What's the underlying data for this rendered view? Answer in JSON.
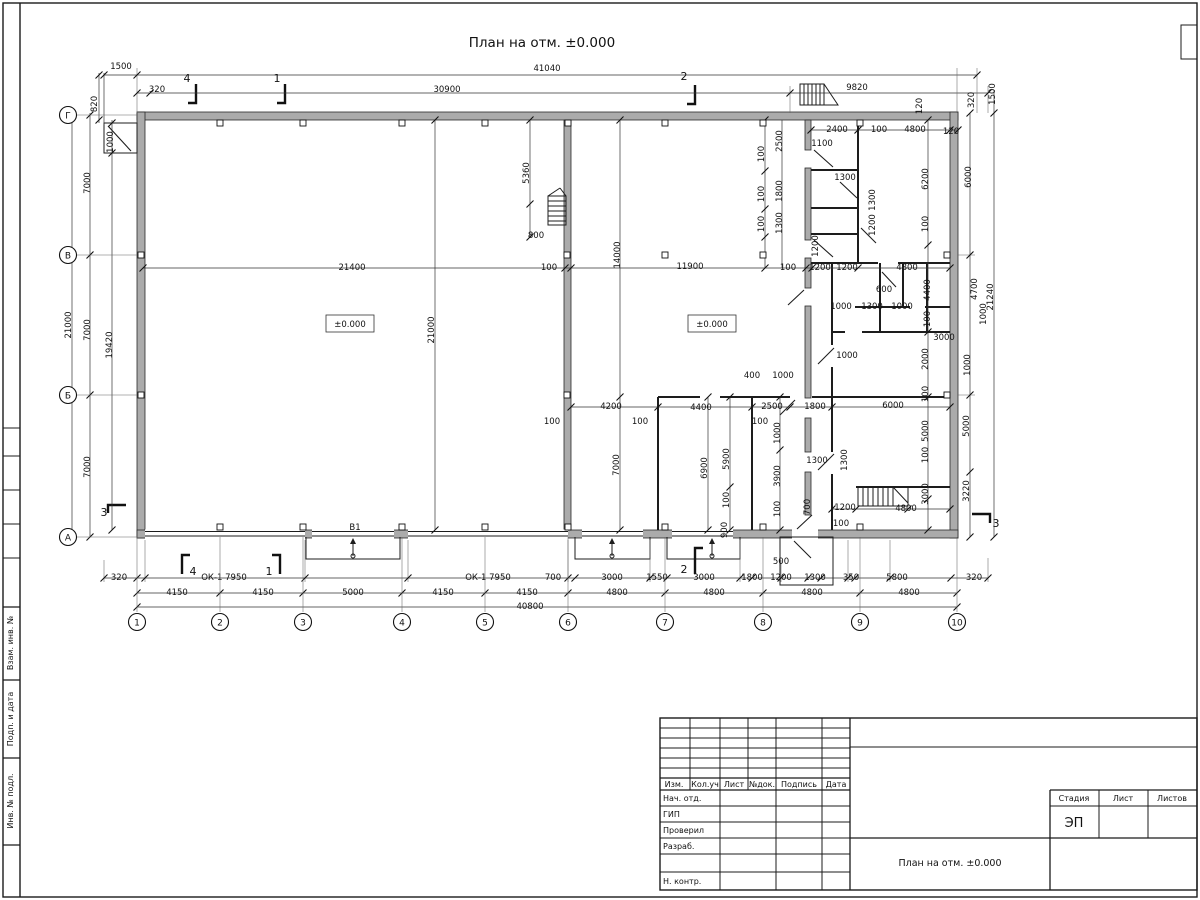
{
  "title_top": "План на отм. ±0.000",
  "frame_left_labels": {
    "l1": "Взам. инв. №",
    "l2": "Подп. и дата",
    "l3": "Инв. № подл."
  },
  "title_block": {
    "rev": {
      "c1": "Изм.",
      "c2": "Кол.уч",
      "c3": "Лист",
      "c4": "№док.",
      "c5": "Подпись",
      "c6": "Дата"
    },
    "roles": {
      "r1": "Нач. отд.",
      "r2": "ГИП",
      "r3": "Проверил",
      "r4": "Разраб.",
      "r5": "Н. контр."
    },
    "stage": {
      "h1": "Стадия",
      "h2": "Лист",
      "h3": "Листов",
      "value": "ЭП"
    },
    "doc_title": "План на отм. ±0.000"
  },
  "axes": {
    "bottom": [
      {
        "n": "1",
        "x": 137
      },
      {
        "n": "2",
        "x": 220
      },
      {
        "n": "3",
        "x": 303
      },
      {
        "n": "4",
        "x": 402
      },
      {
        "n": "5",
        "x": 485
      },
      {
        "n": "6",
        "x": 568
      },
      {
        "n": "7",
        "x": 665
      },
      {
        "n": "8",
        "x": 763
      },
      {
        "n": "9",
        "x": 860
      },
      {
        "n": "10",
        "x": 957
      }
    ],
    "left": [
      {
        "n": "Г",
        "y": 115
      },
      {
        "n": "В",
        "y": 255
      },
      {
        "n": "Б",
        "y": 395
      },
      {
        "n": "А",
        "y": 537
      }
    ]
  },
  "labels": [
    {
      "t": "41040",
      "x": 547,
      "y": 68
    },
    {
      "t": "30900",
      "x": 447,
      "y": 89
    },
    {
      "t": "9820",
      "x": 857,
      "y": 87
    },
    {
      "t": "1500",
      "x": 121,
      "y": 66
    },
    {
      "t": "320",
      "x": 157,
      "y": 89
    },
    {
      "t": "820",
      "x": 97,
      "y": 101,
      "r": 1
    },
    {
      "t": "1000",
      "x": 113,
      "y": 139,
      "r": 1
    },
    {
      "t": "4",
      "x": 187,
      "y": 79,
      "s": 11
    },
    {
      "t": "1",
      "x": 277,
      "y": 79,
      "s": 11
    },
    {
      "t": "2",
      "x": 684,
      "y": 77,
      "s": 11
    },
    {
      "t": "120",
      "x": 922,
      "y": 103,
      "r": 1
    },
    {
      "t": "320",
      "x": 974,
      "y": 97,
      "r": 1
    },
    {
      "t": "1500",
      "x": 995,
      "y": 91,
      "r": 1
    },
    {
      "t": "2400",
      "x": 837,
      "y": 129
    },
    {
      "t": "100",
      "x": 879,
      "y": 129
    },
    {
      "t": "4800",
      "x": 915,
      "y": 129
    },
    {
      "t": "120",
      "x": 951,
      "y": 131
    },
    {
      "t": "1100",
      "x": 822,
      "y": 143
    },
    {
      "t": "2500",
      "x": 782,
      "y": 138,
      "r": 1
    },
    {
      "t": "100",
      "x": 764,
      "y": 151,
      "r": 1
    },
    {
      "t": "1300",
      "x": 845,
      "y": 177
    },
    {
      "t": "1800",
      "x": 782,
      "y": 188,
      "r": 1
    },
    {
      "t": "100",
      "x": 764,
      "y": 191,
      "r": 1
    },
    {
      "t": "1300",
      "x": 782,
      "y": 220,
      "r": 1
    },
    {
      "t": "100",
      "x": 764,
      "y": 221,
      "r": 1
    },
    {
      "t": "1200",
      "x": 818,
      "y": 243,
      "r": 1
    },
    {
      "t": "1300",
      "x": 875,
      "y": 197,
      "r": 1
    },
    {
      "t": "1200",
      "x": 875,
      "y": 222,
      "r": 1
    },
    {
      "t": "6200",
      "x": 928,
      "y": 176,
      "r": 1
    },
    {
      "t": "100",
      "x": 928,
      "y": 221,
      "r": 1
    },
    {
      "t": "6000",
      "x": 971,
      "y": 174,
      "r": 1
    },
    {
      "t": "100",
      "x": 788,
      "y": 267
    },
    {
      "t": "1200",
      "x": 820,
      "y": 267
    },
    {
      "t": "1200",
      "x": 847,
      "y": 267
    },
    {
      "t": "4800",
      "x": 907,
      "y": 267
    },
    {
      "t": "5360",
      "x": 529,
      "y": 170,
      "r": 1
    },
    {
      "t": "800",
      "x": 536,
      "y": 235
    },
    {
      "t": "100",
      "x": 549,
      "y": 267
    },
    {
      "t": "21400",
      "x": 352,
      "y": 267
    },
    {
      "t": "11900",
      "x": 690,
      "y": 266
    },
    {
      "t": "±0.000",
      "x": 350,
      "y": 324,
      "b": 1
    },
    {
      "t": "±0.000",
      "x": 712,
      "y": 324,
      "b": 1
    },
    {
      "t": "21000",
      "x": 434,
      "y": 327,
      "r": 1
    },
    {
      "t": "14000",
      "x": 620,
      "y": 252,
      "r": 1
    },
    {
      "t": "7000",
      "x": 90,
      "y": 180,
      "r": 1
    },
    {
      "t": "7000",
      "x": 90,
      "y": 327,
      "r": 1
    },
    {
      "t": "7000",
      "x": 90,
      "y": 464,
      "r": 1
    },
    {
      "t": "21000",
      "x": 71,
      "y": 322,
      "r": 1
    },
    {
      "t": "19420",
      "x": 112,
      "y": 342,
      "r": 1
    },
    {
      "t": "3",
      "x": 104,
      "y": 513,
      "s": 11
    },
    {
      "t": "600",
      "x": 884,
      "y": 289
    },
    {
      "t": "1000",
      "x": 841,
      "y": 306
    },
    {
      "t": "1300",
      "x": 872,
      "y": 306
    },
    {
      "t": "1000",
      "x": 902,
      "y": 306
    },
    {
      "t": "4400",
      "x": 930,
      "y": 287,
      "r": 1
    },
    {
      "t": "100",
      "x": 930,
      "y": 316,
      "r": 1
    },
    {
      "t": "4700",
      "x": 977,
      "y": 286,
      "r": 1
    },
    {
      "t": "21240",
      "x": 993,
      "y": 294,
      "r": 1
    },
    {
      "t": "1000",
      "x": 986,
      "y": 311,
      "r": 1
    },
    {
      "t": "3000",
      "x": 944,
      "y": 337
    },
    {
      "t": "2000",
      "x": 928,
      "y": 356,
      "r": 1
    },
    {
      "t": "100",
      "x": 928,
      "y": 391,
      "r": 1
    },
    {
      "t": "1000",
      "x": 970,
      "y": 362,
      "r": 1
    },
    {
      "t": "1000",
      "x": 847,
      "y": 355
    },
    {
      "t": "400",
      "x": 752,
      "y": 375
    },
    {
      "t": "1000",
      "x": 783,
      "y": 375
    },
    {
      "t": "2500",
      "x": 772,
      "y": 406
    },
    {
      "t": "1800",
      "x": 815,
      "y": 406
    },
    {
      "t": "6000",
      "x": 893,
      "y": 405
    },
    {
      "t": "100",
      "x": 760,
      "y": 421
    },
    {
      "t": "1000",
      "x": 780,
      "y": 430,
      "r": 1
    },
    {
      "t": "3900",
      "x": 780,
      "y": 473,
      "r": 1
    },
    {
      "t": "100",
      "x": 780,
      "y": 506,
      "r": 1
    },
    {
      "t": "1300",
      "x": 817,
      "y": 460
    },
    {
      "t": "1300",
      "x": 847,
      "y": 457,
      "r": 1
    },
    {
      "t": "5000",
      "x": 928,
      "y": 428,
      "r": 1
    },
    {
      "t": "100",
      "x": 928,
      "y": 452,
      "r": 1
    },
    {
      "t": "3000",
      "x": 928,
      "y": 491,
      "r": 1
    },
    {
      "t": "5000",
      "x": 969,
      "y": 423,
      "r": 1
    },
    {
      "t": "3220",
      "x": 969,
      "y": 488,
      "r": 1
    },
    {
      "t": "700",
      "x": 810,
      "y": 504,
      "r": 1
    },
    {
      "t": "1200",
      "x": 845,
      "y": 507
    },
    {
      "t": "100",
      "x": 841,
      "y": 523
    },
    {
      "t": "4800",
      "x": 906,
      "y": 508
    },
    {
      "t": "3",
      "x": 996,
      "y": 524,
      "s": 11
    },
    {
      "t": "500",
      "x": 781,
      "y": 561
    },
    {
      "t": "900",
      "x": 727,
      "y": 527,
      "r": 1
    },
    {
      "t": "100",
      "x": 552,
      "y": 421
    },
    {
      "t": "4200",
      "x": 611,
      "y": 406
    },
    {
      "t": "100",
      "x": 640,
      "y": 421
    },
    {
      "t": "4400",
      "x": 701,
      "y": 407
    },
    {
      "t": "7000",
      "x": 619,
      "y": 462,
      "r": 1
    },
    {
      "t": "6900",
      "x": 707,
      "y": 465,
      "r": 1
    },
    {
      "t": "5900",
      "x": 729,
      "y": 456,
      "r": 1
    },
    {
      "t": "100",
      "x": 729,
      "y": 497,
      "r": 1
    },
    {
      "t": "320",
      "x": 119,
      "y": 577
    },
    {
      "t": "ОК-1 7950",
      "x": 224,
      "y": 577
    },
    {
      "t": "4",
      "x": 193,
      "y": 572,
      "s": 11
    },
    {
      "t": "1",
      "x": 269,
      "y": 572,
      "s": 11
    },
    {
      "t": "В1",
      "x": 355,
      "y": 527
    },
    {
      "t": "ОК-1 7950",
      "x": 488,
      "y": 577
    },
    {
      "t": "700",
      "x": 553,
      "y": 577
    },
    {
      "t": "3000",
      "x": 612,
      "y": 577
    },
    {
      "t": "1550",
      "x": 657,
      "y": 577
    },
    {
      "t": "2",
      "x": 684,
      "y": 570,
      "s": 11
    },
    {
      "t": "3000",
      "x": 704,
      "y": 577
    },
    {
      "t": "1800",
      "x": 752,
      "y": 577
    },
    {
      "t": "1200",
      "x": 781,
      "y": 577
    },
    {
      "t": "1300",
      "x": 815,
      "y": 577
    },
    {
      "t": "350",
      "x": 851,
      "y": 577
    },
    {
      "t": "5800",
      "x": 897,
      "y": 577
    },
    {
      "t": "320",
      "x": 974,
      "y": 577
    },
    {
      "t": "4150",
      "x": 177,
      "y": 592
    },
    {
      "t": "4150",
      "x": 263,
      "y": 592
    },
    {
      "t": "5000",
      "x": 353,
      "y": 592
    },
    {
      "t": "4150",
      "x": 443,
      "y": 592
    },
    {
      "t": "4150",
      "x": 527,
      "y": 592
    },
    {
      "t": "4800",
      "x": 617,
      "y": 592
    },
    {
      "t": "4800",
      "x": 714,
      "y": 592
    },
    {
      "t": "4800",
      "x": 812,
      "y": 592
    },
    {
      "t": "4800",
      "x": 909,
      "y": 592
    },
    {
      "t": "40800",
      "x": 530,
      "y": 606
    }
  ]
}
